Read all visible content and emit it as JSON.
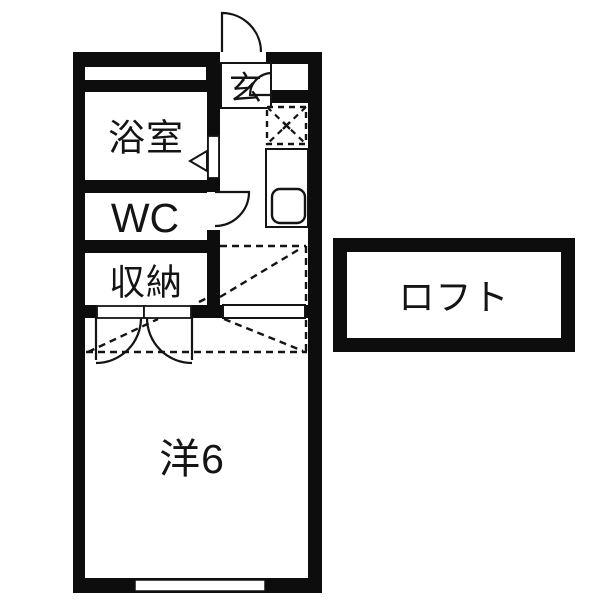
{
  "plan": {
    "type": "japanese-apartment-floor-plan",
    "colors": {
      "wall": "#0d0d0d",
      "background": "#ffffff",
      "line": "#141414"
    },
    "rooms": {
      "genkan": {
        "label": "玄"
      },
      "bathroom": {
        "label": "浴室"
      },
      "toilet": {
        "label": "WC"
      },
      "storage": {
        "label": "収納"
      },
      "main_room": {
        "label": "洋6"
      },
      "loft": {
        "label": "ロフト"
      }
    },
    "symbols": [
      "entrance-swing-door",
      "genkan-inner-swing-door",
      "bathroom-folding-door-arrow",
      "wc-swing-door",
      "storage-double-doors",
      "refrigerator-space-dashed-box",
      "kitchen-counter-with-sink",
      "loft-extent-dashed-outline",
      "windows"
    ]
  }
}
